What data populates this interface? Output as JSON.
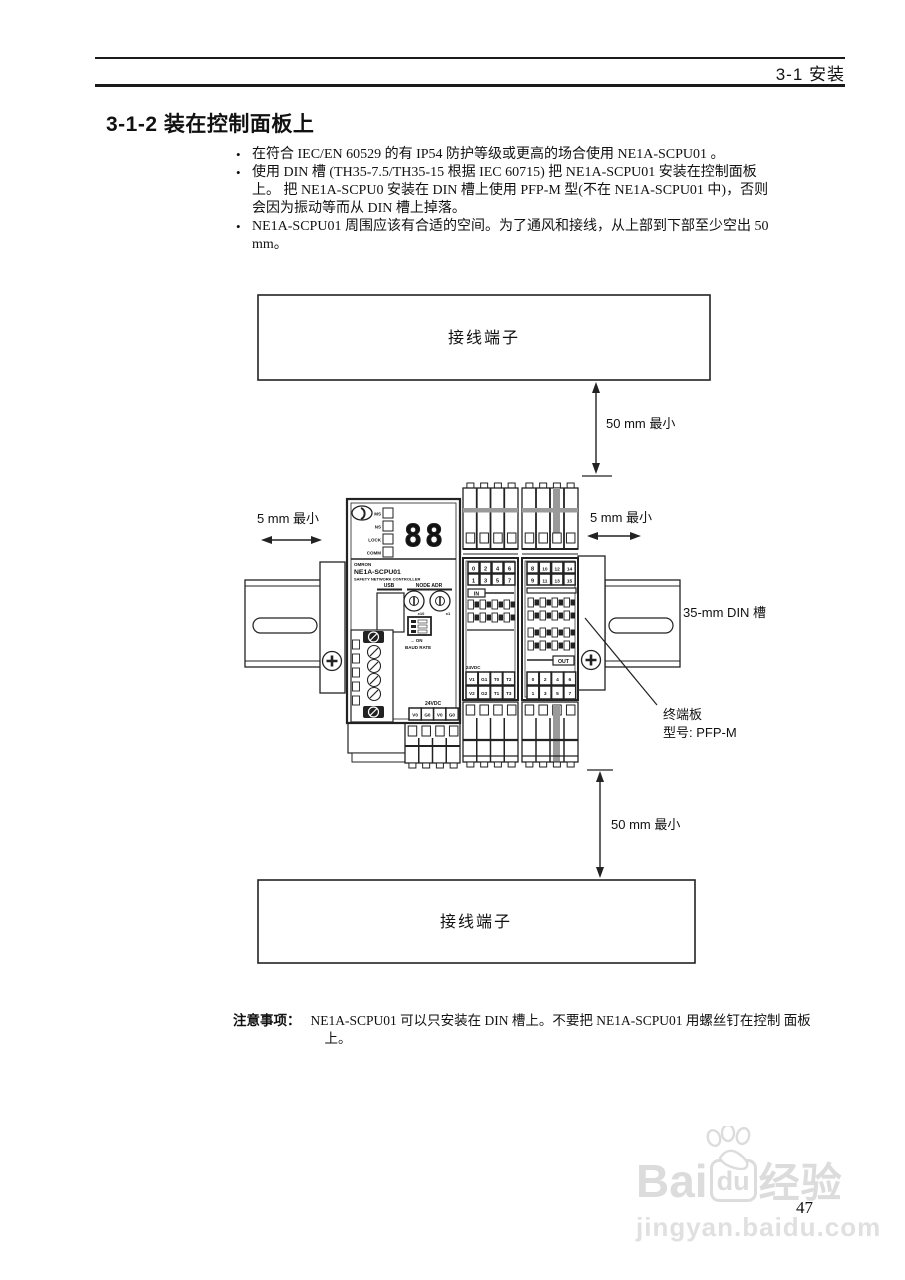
{
  "header": {
    "section": "3-1  安装"
  },
  "title": "3-1-2  装在控制面板上",
  "bullets": [
    {
      "marker": "•",
      "lines": [
        "在符合 IEC/EN 60529 的有 IP54 防护等级或更高的场合使用 NE1A-SCPU01 。"
      ]
    },
    {
      "marker": "•",
      "lines": [
        "使用 DIN 槽 (TH35-7.5/TH35-15 根据 IEC 60715) 把 NE1A-SCPU01 安装在控制面板",
        "上。 把 NE1A-SCPU0 安装在 DIN 槽上使用 PFP-M 型(不在 NE1A-SCPU01 中)，否则",
        "会因为振动等而从 DIN 槽上掉落。"
      ]
    },
    {
      "marker": "•",
      "lines": [
        "NE1A-SCPU01 周围应该有合适的空间。为了通风和接线，从上部到下部至少空出 50",
        "mm。"
      ]
    }
  ],
  "diagram": {
    "terminal_top": "接线端子",
    "terminal_bottom": "接线端子",
    "gap_top": "50 mm 最小",
    "gap_bottom": "50 mm  最小",
    "gap_left": "5 mm 最小",
    "gap_right": "5 mm 最小",
    "din_label": "35-mm DIN  槽",
    "endplate": {
      "line1": "终端板",
      "line2": "型号: PFP-M"
    },
    "device": {
      "leds": [
        "MS",
        "NS",
        "LOCK",
        "COMM"
      ],
      "display": "88",
      "brand": "OMRON",
      "model": "NE1A-SCPU01",
      "type": "SAFETY NETWORK CONTROLLER",
      "usb": "USB",
      "node_adr": "NODE ADR",
      "x10": "x10",
      "x1": "x1",
      "on": "→ ON",
      "baud": "BAUD RATE",
      "vdc": "24VDC",
      "power_terms": [
        "V0",
        "G0",
        "V0",
        "G0"
      ]
    },
    "moduleA": {
      "row1": [
        "0",
        "2",
        "4",
        "6"
      ],
      "row2": [
        "1",
        "3",
        "5",
        "7"
      ],
      "tab": "IN",
      "vdc": "24VDC",
      "term1": [
        "V1",
        "G1",
        "T0",
        "T2"
      ],
      "term2": [
        "V2",
        "G2",
        "T1",
        "T3"
      ]
    },
    "moduleB": {
      "row1": [
        "8",
        "10",
        "12",
        "14"
      ],
      "row2": [
        "9",
        "11",
        "13",
        "15"
      ],
      "tab": "OUT",
      "out1": [
        "0",
        "2",
        "4",
        "6"
      ],
      "out2": [
        "1",
        "3",
        "5",
        "7"
      ]
    }
  },
  "note": {
    "label": "注意事项：",
    "line1": "NE1A-SCPU01 可以只安装在 DIN 槽上。不要把 NE1A-SCPU01 用螺丝钉在控制 面板",
    "line2": "上。"
  },
  "watermark": {
    "brand_left": "Bai",
    "brand_mid": "du",
    "brand_right": "经验",
    "url": "jingyan.baidu.com"
  },
  "page": {
    "number": "47"
  }
}
